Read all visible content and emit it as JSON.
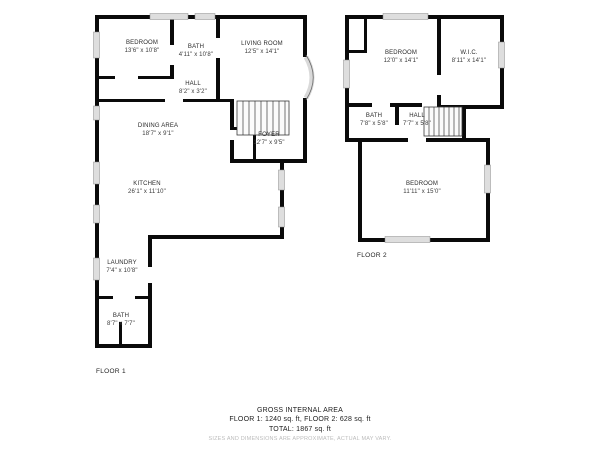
{
  "colors": {
    "background": "#ffffff",
    "wall": "#0a0a0a",
    "window": "#dedede",
    "text": "#2b2b2b",
    "disclaimer_text": "#bcbcbc"
  },
  "floor1": {
    "label": "FLOOR 1",
    "rooms": [
      {
        "name": "BEDROOM",
        "dims": "13'6\" x 10'8\""
      },
      {
        "name": "BATH",
        "dims": "4'11\" x 10'8\""
      },
      {
        "name": "LIVING ROOM",
        "dims": "12'5\" x 14'1\""
      },
      {
        "name": "HALL",
        "dims": "8'2\" x 3'2\""
      },
      {
        "name": "DINING AREA",
        "dims": "18'7\" x 9'1\""
      },
      {
        "name": "FOYER",
        "dims": "12'7\" x 9'5\""
      },
      {
        "name": "KITCHEN",
        "dims": "26'1\" x 11'10\""
      },
      {
        "name": "LAUNDRY",
        "dims": "7'4\" x 10'8\""
      },
      {
        "name": "BATH",
        "dims": "8'7\" x 7'7\""
      }
    ]
  },
  "floor2": {
    "label": "FLOOR 2",
    "rooms": [
      {
        "name": "BEDROOM",
        "dims": "12'0\" x 14'1\""
      },
      {
        "name": "W.I.C.",
        "dims": "8'11\" x 14'1\""
      },
      {
        "name": "BATH",
        "dims": "7'8\" x 5'8\""
      },
      {
        "name": "HALL",
        "dims": "7'7\" x 5'8\""
      },
      {
        "name": "BEDROOM",
        "dims": "11'11\" x 15'0\""
      }
    ]
  },
  "footer": {
    "title": "GROSS INTERNAL AREA",
    "areas": "FLOOR 1: 1240 sq. ft, FLOOR 2: 628 sq. ft",
    "total": "TOTAL: 1867 sq. ft",
    "disclaimer": "SIZES AND DIMENSIONS ARE APPROXIMATE, ACTUAL MAY VARY."
  }
}
